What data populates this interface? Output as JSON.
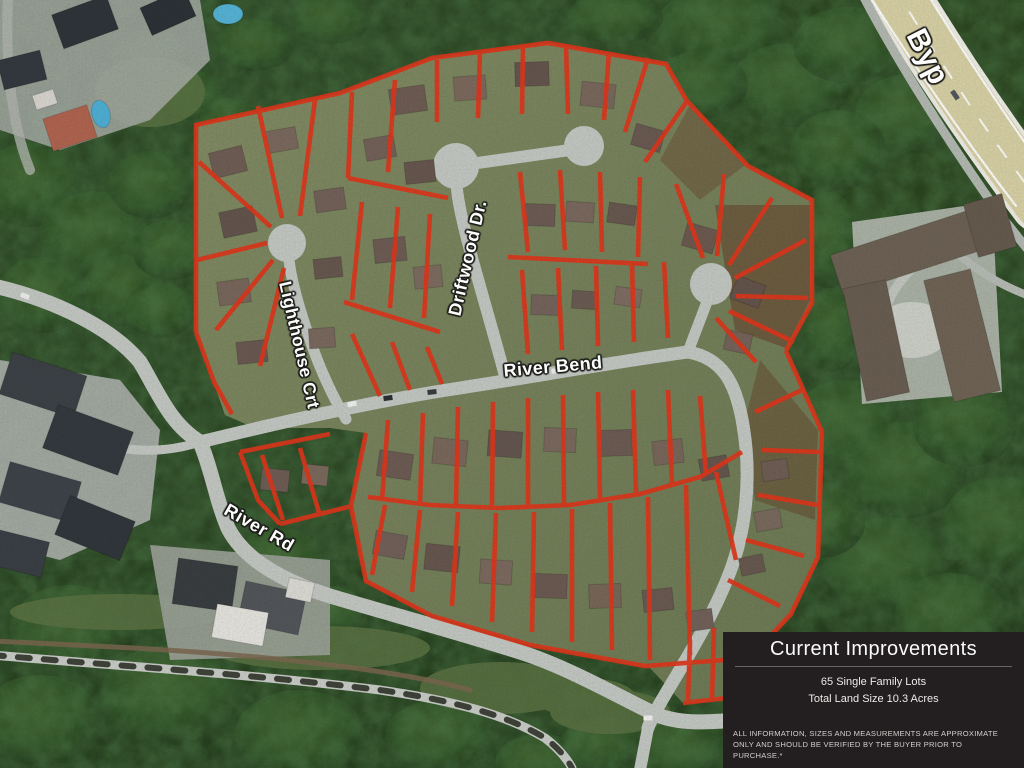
{
  "map": {
    "kind": "aerial-subdivision-plan",
    "street_labels": [
      {
        "id": "driftwood-dr",
        "text": "Driftwood Dr."
      },
      {
        "id": "lighthouse-crt",
        "text": "Lighthouse Crt"
      },
      {
        "id": "river-bend",
        "text": "River Bend"
      },
      {
        "id": "river-rd",
        "text": "River Rd"
      },
      {
        "id": "bypass",
        "text": "Byp"
      }
    ],
    "colors": {
      "lot_line": "#e0371c",
      "road": "#c4c8c3",
      "foliage": "#2c4724",
      "highway": "#d8d1a6",
      "panel_background": "#231e1f"
    }
  },
  "info_panel": {
    "title": "Current Improvements",
    "lines": [
      "65 Single Family Lots",
      "Total Land Size 10.3 Acres"
    ],
    "disclaimer": "ALL INFORMATION, SIZES AND MEASUREMENTS ARE APPROXIMATE ONLY AND SHOULD BE VERIFIED BY THE BUYER PRIOR TO PURCHASE.*"
  }
}
